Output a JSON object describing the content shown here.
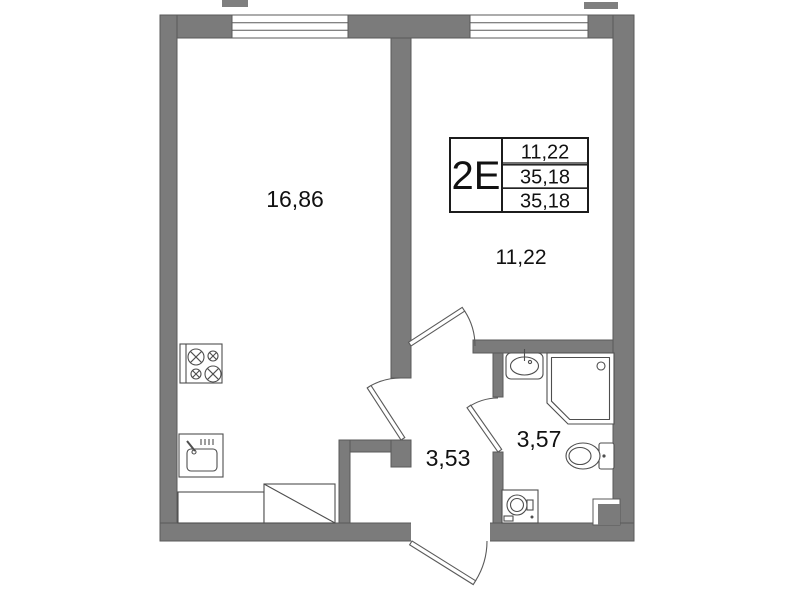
{
  "floorplan": {
    "info_table": {
      "col1": "2Е",
      "values": [
        "11,22",
        "35,18",
        "35,18"
      ]
    },
    "rooms": {
      "living": {
        "label": "16,86"
      },
      "bedroom": {
        "label": "11,22"
      },
      "hallway": {
        "label": "3,53"
      },
      "bathroom": {
        "label": "3,57"
      }
    },
    "colors": {
      "wall": "#7b7b7b",
      "outline": "#555555",
      "background": "#ffffff",
      "text": "#111111"
    }
  }
}
